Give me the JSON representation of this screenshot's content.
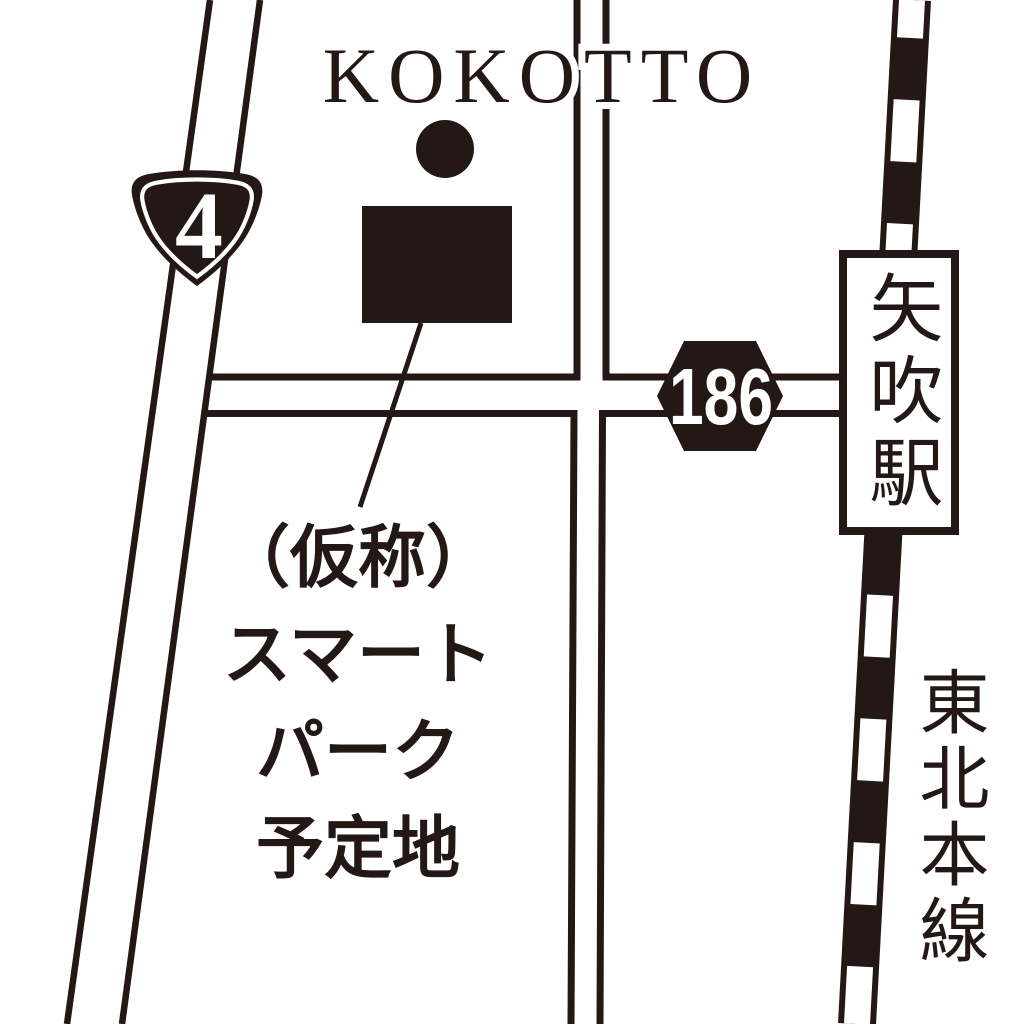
{
  "map": {
    "title": "KOKOTTO",
    "route4_number": "4",
    "route186_number": "186",
    "station_name": "矢吹駅",
    "rail_line_name": "東北本線",
    "site_label_lines": [
      "（仮称）",
      "スマート",
      "パーク",
      "予定地"
    ],
    "colors": {
      "ink": "#231815",
      "background": "#ffffff"
    }
  }
}
